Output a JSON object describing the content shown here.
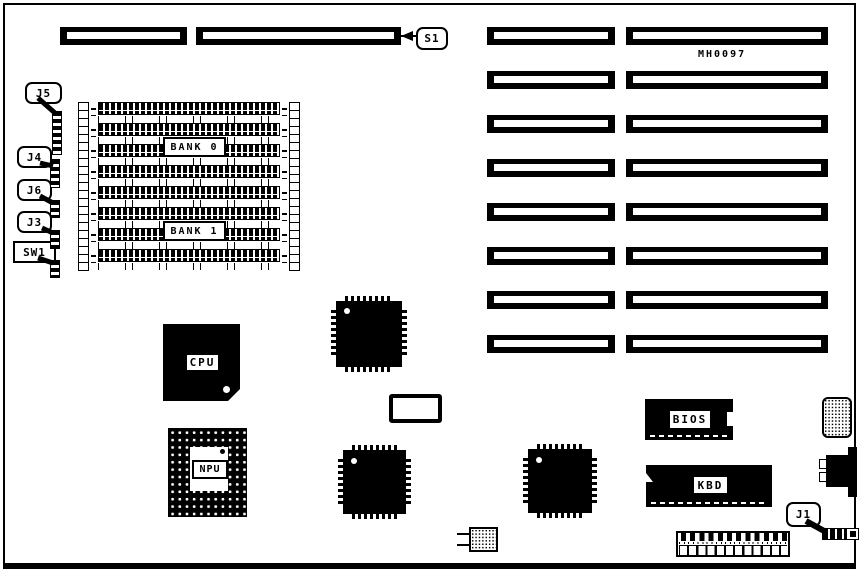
{
  "board": {
    "part_number": "MH0097",
    "callouts": {
      "s1": "S1",
      "j5": "J5",
      "j4": "J4",
      "j6": "J6",
      "j3": "J3",
      "sw1": "SW1",
      "j1": "J1"
    },
    "memory": {
      "bank0": "BANK 0",
      "bank1": "BANK 1"
    },
    "chips": {
      "cpu": "CPU",
      "npu": "NPU",
      "bios": "BIOS",
      "kbd": "KBD"
    }
  }
}
